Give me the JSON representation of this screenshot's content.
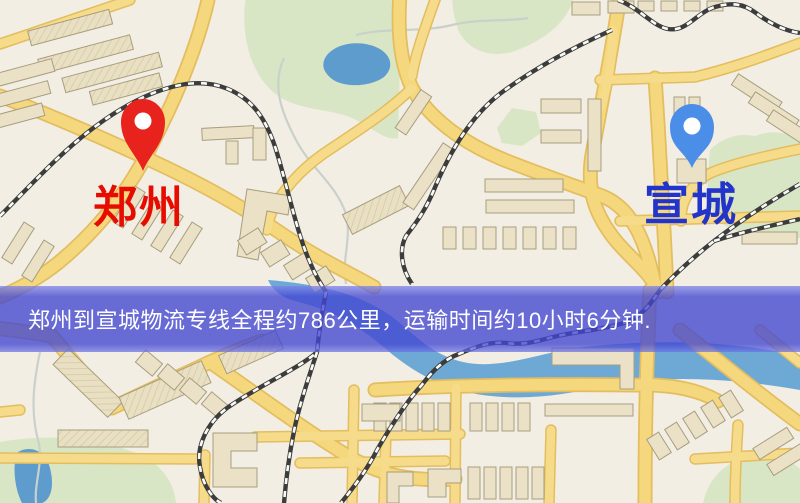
{
  "map": {
    "origin": {
      "label": "郑州",
      "icon": "map-pin-icon",
      "pin_color": "#e8231d",
      "label_color": "#e60c00"
    },
    "destination": {
      "label": "宣城",
      "icon": "map-pin-icon",
      "pin_color": "#4a8ee8",
      "label_color": "#2334cb"
    },
    "palette": {
      "background": "#f2eee4",
      "road_fill": "#f5d87e",
      "road_edge": "#e3bd5e",
      "water": "#5f9cce",
      "park": "#d9e6c5",
      "building": "#eae1c6",
      "railway": "#3c3c3c"
    }
  },
  "banner": {
    "text": "郑州到宣城物流专线全程约786公里，运输时间约10小时6分钟.",
    "background": "#4246d1",
    "text_color": "#ffffff"
  }
}
